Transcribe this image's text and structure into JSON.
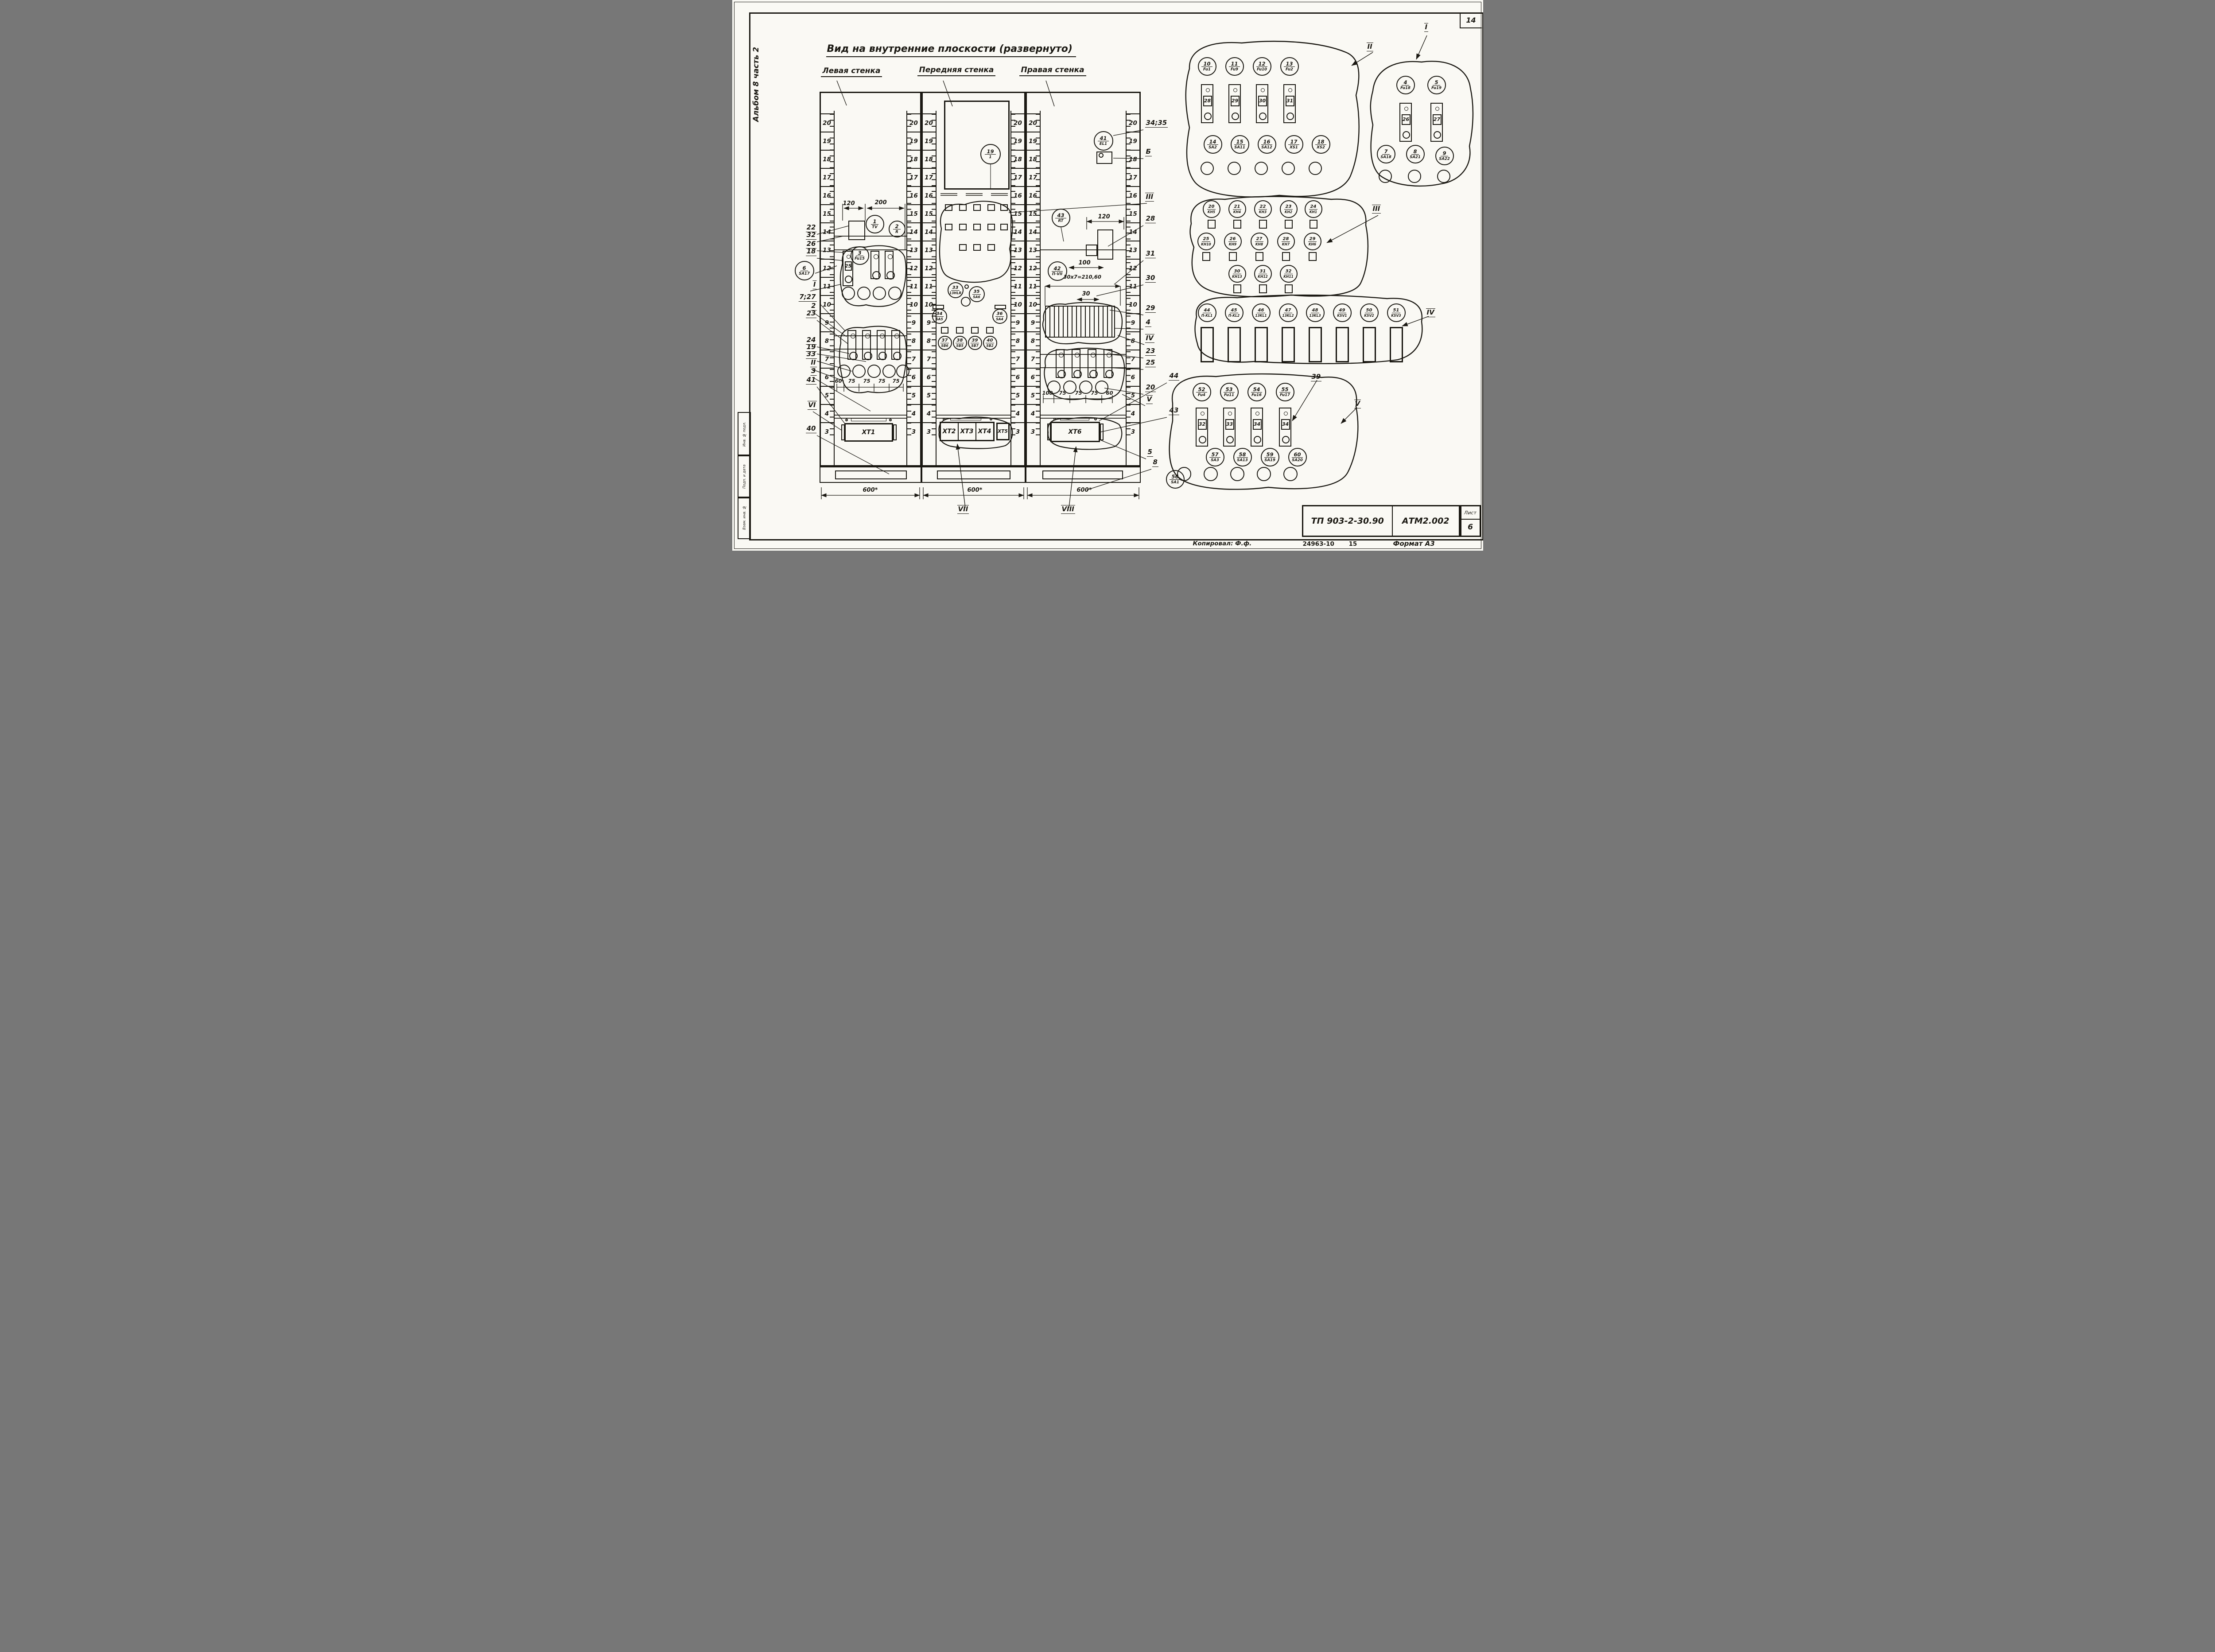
{
  "sheet": {
    "page_number": "14",
    "album_label": "Альбом 8 часть 2",
    "stamp_labels": [
      "Инв. № подл.",
      "Подп. и дата",
      "Взам. инв. №"
    ],
    "title": "Вид на внутренние плоскости (развернуто)",
    "bottom_row": {
      "copied": "Копировал: Ф.ф.",
      "order_no": "24963-10",
      "sheets": "15",
      "format": "Формат А3"
    },
    "title_block": {
      "code": "ТП 903-2-30.90",
      "doc": "АТМ2.002",
      "sheet_label": "Лист",
      "sheet_no": "6"
    }
  },
  "ruler_numbers": [
    "20",
    "19",
    "18",
    "17",
    "16",
    "15",
    "14",
    "13",
    "12",
    "11",
    "10",
    "9",
    "8",
    "7",
    "6",
    "5",
    "4",
    "3"
  ],
  "panels": {
    "left": {
      "title": "Левая стенка",
      "bottom_dim": "600*",
      "dims_top": [
        "120",
        "200"
      ],
      "dims_bottom": [
        "60",
        "75",
        "75",
        "75",
        "75"
      ],
      "components": [
        {
          "n": "1",
          "t": "TV"
        },
        {
          "n": "2",
          "t": "R"
        },
        {
          "n": "3",
          "t": "Fu15"
        }
      ],
      "margin_component": {
        "n": "6",
        "t": "SA17"
      },
      "holder_number": "25",
      "terminal": "XT1"
    },
    "front": {
      "title": "Передняя стенка",
      "bottom_dim": "600*",
      "window_component": {
        "n": "19",
        "t": "1"
      },
      "components": [
        {
          "n": "33",
          "t": "13HLR"
        },
        {
          "n": "35",
          "t": "SA6"
        },
        {
          "n": "34",
          "t": "SA5"
        },
        {
          "n": "36",
          "t": "SA4"
        },
        {
          "n": "37",
          "t": "SB6"
        },
        {
          "n": "38",
          "t": "SB5"
        },
        {
          "n": "39",
          "t": "SB7"
        },
        {
          "n": "40",
          "t": "SB2"
        }
      ],
      "terminals": [
        "XT2",
        "XT3",
        "XT4",
        "XT5"
      ],
      "section_label": "VII"
    },
    "right": {
      "title": "Правая стенка",
      "bottom_dim": "600*",
      "dims": [
        "120",
        "100",
        "30х7=210,60",
        "30"
      ],
      "dims_bottom": [
        "100",
        "75",
        "75",
        "75",
        "60"
      ],
      "components": [
        {
          "n": "41",
          "t": "EL1"
        },
        {
          "n": "43",
          "t": "RT"
        },
        {
          "n": "42",
          "t": "П-VII"
        }
      ],
      "terminal": "XT6",
      "section_label": "VIII"
    }
  },
  "left_callouts": [
    "22",
    "32",
    "26",
    "18",
    "I",
    "7;27",
    "2",
    "23",
    "24",
    "19",
    "33",
    "II",
    "3",
    "41",
    "VI",
    "40"
  ],
  "right_callouts": [
    "34;35",
    "Б",
    "III",
    "28",
    "31",
    "30",
    "29",
    "4",
    "IV",
    "23",
    "25",
    "44",
    "20",
    "V",
    "43",
    "5",
    "8"
  ],
  "groups": {
    "g1": {
      "label": "I",
      "fuses": [
        {
          "n": "4",
          "t": "Fu18"
        },
        {
          "n": "5",
          "t": "Fu19"
        }
      ],
      "holder_numbers": [
        "26",
        "27"
      ],
      "switches": [
        {
          "n": "7",
          "t": "SA18"
        },
        {
          "n": "8",
          "t": "SA21"
        },
        {
          "n": "9",
          "t": "SA22"
        }
      ]
    },
    "g2": {
      "label": "II",
      "fuses": [
        {
          "n": "10",
          "t": "Fu1"
        },
        {
          "n": "11",
          "t": "Fu9"
        },
        {
          "n": "12",
          "t": "Fu10"
        },
        {
          "n": "13",
          "t": "Fu2"
        }
      ],
      "holder_numbers": [
        "28",
        "29",
        "30",
        "31"
      ],
      "switches": [
        {
          "n": "14",
          "t": "SA2"
        },
        {
          "n": "15",
          "t": "SA11"
        },
        {
          "n": "16",
          "t": "SA12"
        },
        {
          "n": "17",
          "t": "XS1"
        },
        {
          "n": "18",
          "t": "XS2"
        }
      ]
    },
    "g3": {
      "label": "III",
      "rows": [
        [
          {
            "n": "20",
            "t": "KH5"
          },
          {
            "n": "21",
            "t": "KH4"
          },
          {
            "n": "22",
            "t": "KH3"
          },
          {
            "n": "23",
            "t": "KH2"
          },
          {
            "n": "24",
            "t": "KH1"
          }
        ],
        [
          {
            "n": "25",
            "t": "KH10"
          },
          {
            "n": "26",
            "t": "KH9"
          },
          {
            "n": "27",
            "t": "KH8"
          },
          {
            "n": "28",
            "t": "KH7"
          },
          {
            "n": "29",
            "t": "KH6"
          }
        ],
        [
          {
            "n": "30",
            "t": "KH13"
          },
          {
            "n": "31",
            "t": "KH12"
          },
          {
            "n": "32",
            "t": "KH11"
          }
        ]
      ]
    },
    "g4": {
      "label": "IV",
      "relays": [
        {
          "n": "44",
          "t": "П-KL1"
        },
        {
          "n": "45",
          "t": "П-KL2"
        },
        {
          "n": "46",
          "t": "13KL1"
        },
        {
          "n": "47",
          "t": "13KL2"
        },
        {
          "n": "48",
          "t": "13KL3"
        },
        {
          "n": "49",
          "t": "KSV1"
        },
        {
          "n": "50",
          "t": "KSV2"
        },
        {
          "n": "51",
          "t": "KSV3"
        }
      ]
    },
    "g5": {
      "label": "V",
      "callout": "39",
      "fuses": [
        {
          "n": "52",
          "t": "Fu4"
        },
        {
          "n": "53",
          "t": "Fu11"
        },
        {
          "n": "54",
          "t": "Fu16"
        },
        {
          "n": "55",
          "t": "Fu17"
        }
      ],
      "holder_numbers": [
        "32",
        "33",
        "34",
        "34"
      ],
      "switches": [
        {
          "n": "57",
          "t": "SA3"
        },
        {
          "n": "58",
          "t": "SA13"
        },
        {
          "n": "59",
          "t": "SA19"
        },
        {
          "n": "60",
          "t": "SA20"
        }
      ],
      "extra_switch": {
        "n": "56",
        "t": "SA1"
      }
    }
  }
}
